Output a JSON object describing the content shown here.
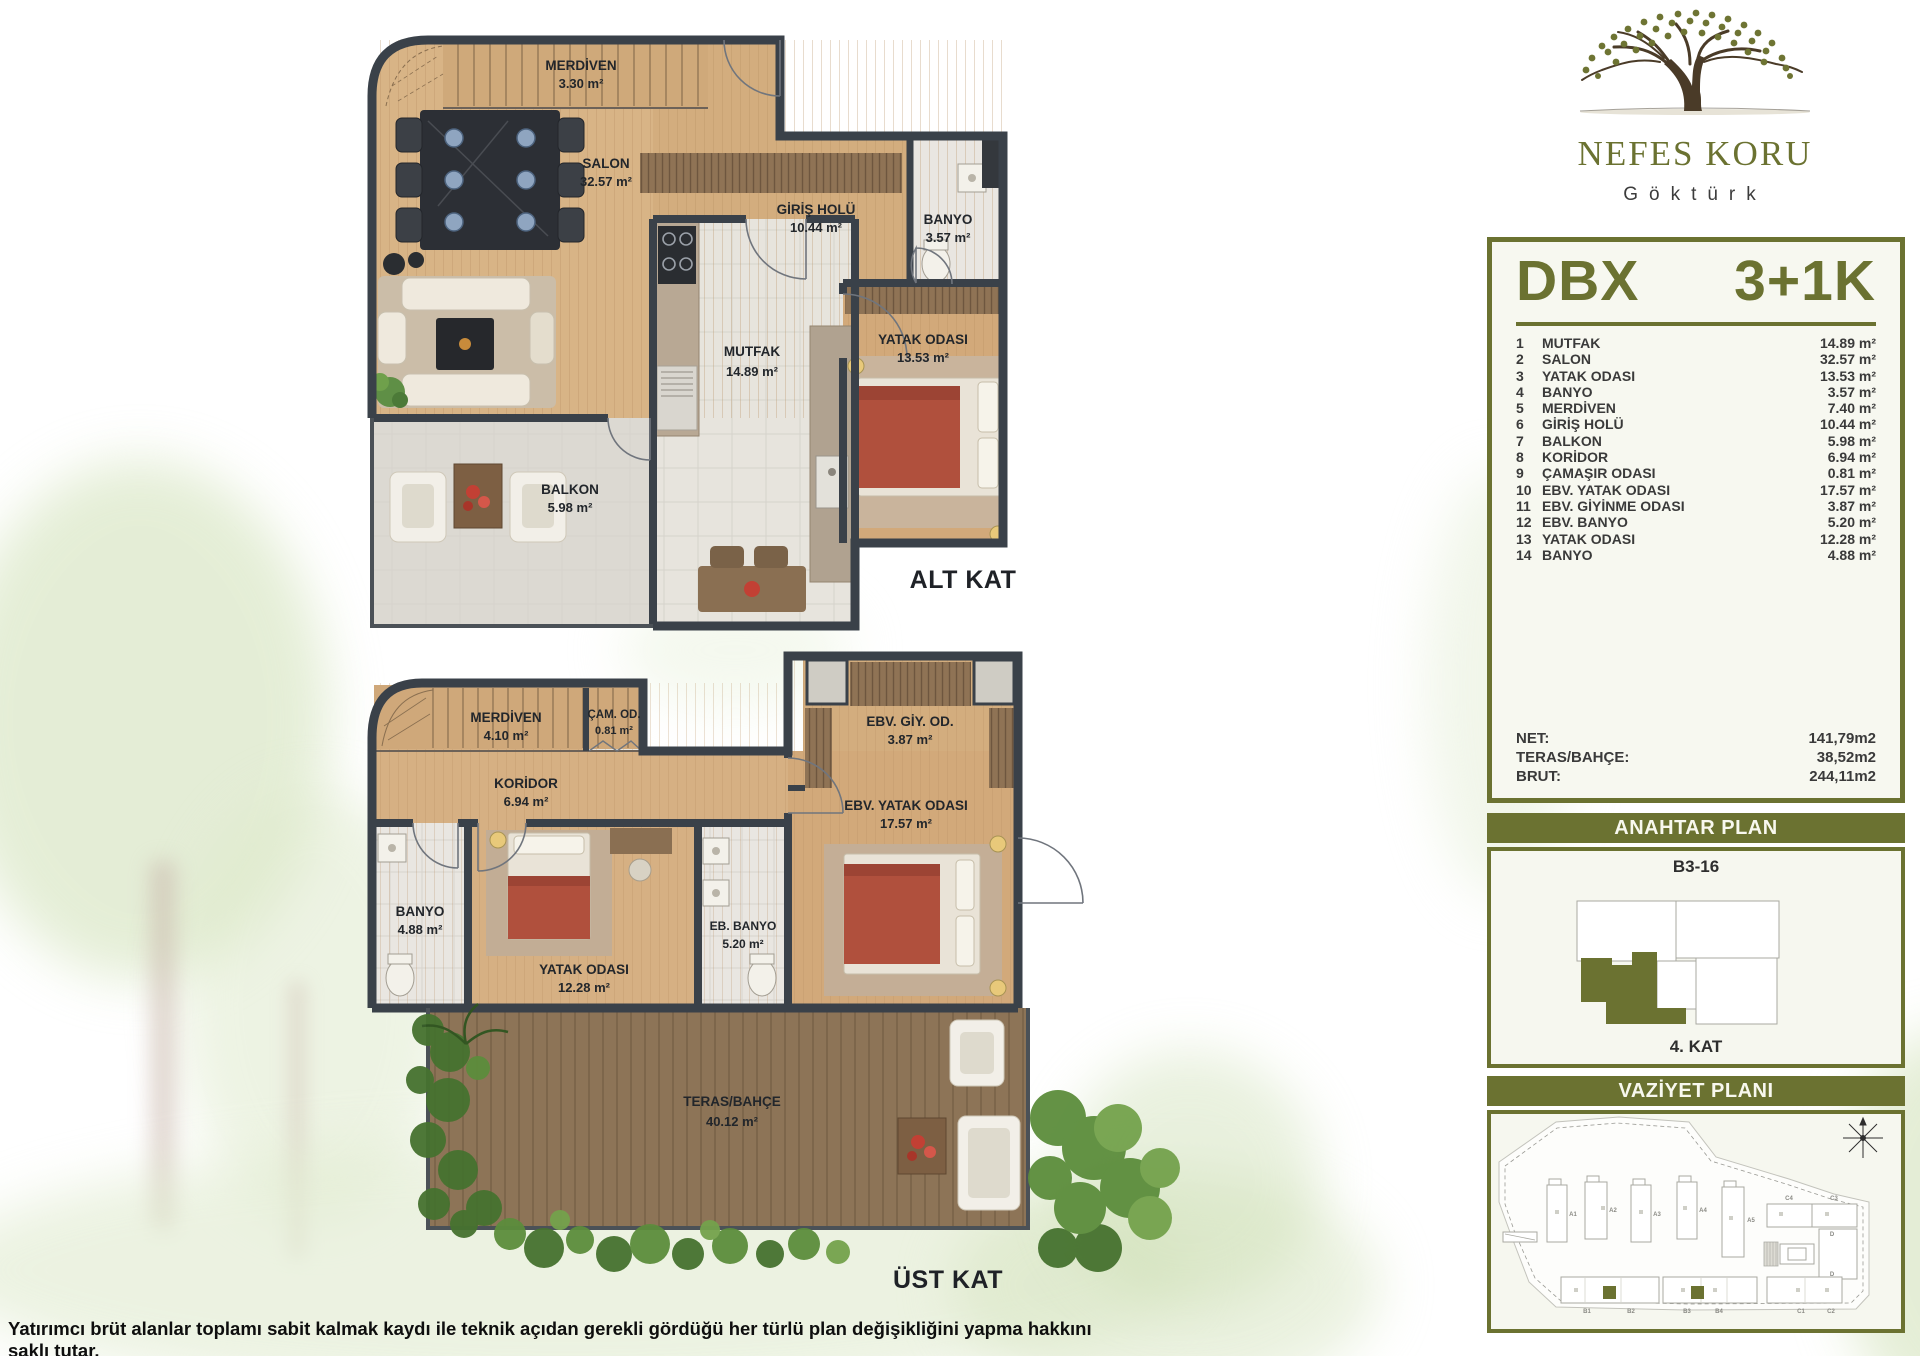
{
  "brand": {
    "name": "NEFES KORU",
    "location": "Göktürk"
  },
  "unit": {
    "code": "DBX",
    "type": "3+1K",
    "rooms": [
      {
        "no": "1",
        "name": "MUTFAK",
        "area": "14.89 m²"
      },
      {
        "no": "2",
        "name": "SALON",
        "area": "32.57 m²"
      },
      {
        "no": "3",
        "name": "YATAK ODASI",
        "area": "13.53 m²"
      },
      {
        "no": "4",
        "name": "BANYO",
        "area": "3.57 m²"
      },
      {
        "no": "5",
        "name": "MERDİVEN",
        "area": "7.40 m²"
      },
      {
        "no": "6",
        "name": "GİRİŞ HOLÜ",
        "area": "10.44 m²"
      },
      {
        "no": "7",
        "name": "BALKON",
        "area": "5.98 m²"
      },
      {
        "no": "8",
        "name": "KORİDOR",
        "area": "6.94 m²"
      },
      {
        "no": "9",
        "name": "ÇAMAŞIR ODASI",
        "area": "0.81 m²"
      },
      {
        "no": "10",
        "name": "EBV. YATAK ODASI",
        "area": "17.57 m²"
      },
      {
        "no": "11",
        "name": "EBV. GİYİNME ODASI",
        "area": "3.87 m²"
      },
      {
        "no": "12",
        "name": "EBV. BANYO",
        "area": "5.20 m²"
      },
      {
        "no": "13",
        "name": "YATAK ODASI",
        "area": "12.28 m²"
      },
      {
        "no": "14",
        "name": "BANYO",
        "area": "4.88 m²"
      }
    ],
    "totals": [
      {
        "label": "NET:",
        "value": "141,79m2"
      },
      {
        "label": "TERAS/BAHÇE:",
        "value": "38,52m2"
      },
      {
        "label": "BRUT:",
        "value": "244,11m2"
      }
    ]
  },
  "plans": {
    "alt": {
      "caption": "ALT KAT",
      "labels": {
        "merdiven": {
          "name": "MERDİVEN",
          "area": "3.30 m²"
        },
        "salon": {
          "name": "SALON",
          "area": "32.57 m²"
        },
        "giris": {
          "name": "GİRİŞ HOLÜ",
          "area": "10.44 m²"
        },
        "banyo": {
          "name": "BANYO",
          "area": "3.57 m²"
        },
        "mutfak": {
          "name": "MUTFAK",
          "area": "14.89 m²"
        },
        "yatak": {
          "name": "YATAK ODASI",
          "area": "13.53 m²"
        },
        "balkon": {
          "name": "BALKON",
          "area": "5.98 m²"
        }
      }
    },
    "ust": {
      "caption": "ÜST KAT",
      "labels": {
        "merdiven": {
          "name": "MERDİVEN",
          "area": "4.10 m²"
        },
        "cam": {
          "name": "ÇAM. OD.",
          "area": "0.81 m²"
        },
        "koridor": {
          "name": "KORİDOR",
          "area": "6.94 m²"
        },
        "ebv_giy": {
          "name": "EBV. GİY. OD.",
          "area": "3.87 m²"
        },
        "ebv_yatak": {
          "name": "EBV. YATAK ODASI",
          "area": "17.57 m²"
        },
        "banyo": {
          "name": "BANYO",
          "area": "4.88 m²"
        },
        "yatak": {
          "name": "YATAK ODASI",
          "area": "12.28 m²"
        },
        "eb_banyo": {
          "name": "EB. BANYO",
          "area": "5.20 m²"
        },
        "teras": {
          "name": "TERAS/BAHÇE",
          "area": "40.12 m²"
        }
      }
    }
  },
  "key_plan": {
    "title": "ANAHTAR PLAN",
    "unit": "B3-16",
    "floor": "4. KAT"
  },
  "site_plan": {
    "title": "VAZİYET PLANI",
    "buildings": [
      "A1",
      "A2",
      "A3",
      "A4",
      "A5",
      "C4",
      "C3",
      "D",
      "D",
      "B1",
      "B2",
      "B3",
      "B4",
      "C1",
      "C2"
    ]
  },
  "disclaimer": "Yatırımcı brüt alanlar toplamı sabit kalmak kaydı ile teknik açıdan gerekli gördüğü her türlü plan değişikliğini yapma hakkını saklı tutar.",
  "colors": {
    "olive": "#6b7231",
    "wall": "#3a4149",
    "wood": "#d8b385",
    "red": "#b0503d",
    "window_blue": "#3f93cf"
  }
}
